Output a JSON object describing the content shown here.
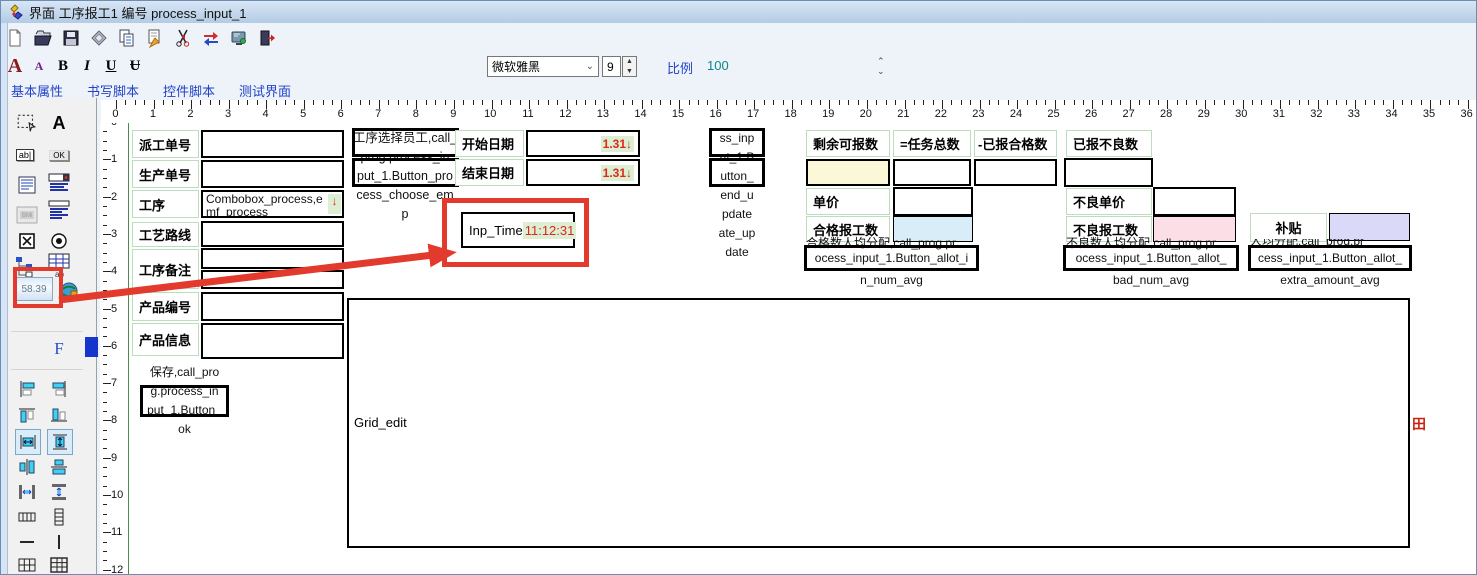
{
  "window": {
    "title": "界面 工序报工1 编号 process_input_1"
  },
  "toolbar": {
    "icons": [
      "new-file",
      "open-folder",
      "save",
      "preview",
      "copy",
      "export",
      "cut",
      "swap-arrows",
      "display",
      "exit"
    ]
  },
  "format": {
    "font_large": "A",
    "font_small": "A",
    "bold": "B",
    "italic": "I",
    "underline": "U",
    "strike": "Ʉ",
    "font_name": "微软雅黑",
    "font_size": "9",
    "scale_label": "比例",
    "scale_value": "100"
  },
  "tabs": {
    "basic": "基本属性",
    "write_script": "书写脚本",
    "control_script": "控件脚本",
    "test_ui": "测试界面"
  },
  "rulers": {
    "h_numbers": [
      0,
      1,
      2,
      3,
      4,
      5,
      6,
      7,
      8,
      9,
      10,
      11,
      12,
      13,
      14,
      15,
      16,
      17,
      18,
      19,
      20,
      21,
      22,
      23,
      24,
      25,
      26,
      27,
      28,
      29,
      30,
      31,
      32,
      33,
      34,
      35,
      36
    ],
    "v_numbers": [
      0,
      1,
      2,
      3,
      4,
      5,
      6,
      7,
      8,
      9,
      10,
      11,
      12
    ]
  },
  "toolbox": {
    "ab": "ab|",
    "ok": "OK",
    "grid_ab": "ab",
    "num_value": "58.39",
    "f": "F"
  },
  "form": {
    "rows": [
      {
        "label": "派工单号"
      },
      {
        "label": "生产单号"
      },
      {
        "label": "工序"
      },
      {
        "label": "工艺路线"
      },
      {
        "label": "工序备注"
      },
      {
        "label": "产品编号"
      },
      {
        "label": "产品信息"
      }
    ],
    "combobox_line1": "Combobox_process,e",
    "combobox_line2": "mf_process",
    "combobox_arrow": "↓"
  },
  "save_button": {
    "l1": "保存,call_pro",
    "l2": "g.process_in",
    "l3": "put_1.Button_",
    "l4": "ok"
  },
  "choose_emp": {
    "l1": "工序选择员工,call_",
    "l2": "prog.process_in",
    "l3": "put_1.Button_pro",
    "l4": "cess_choose_em",
    "l5": "p"
  },
  "dates": {
    "start_label": "开始日期",
    "end_label": "结束日期",
    "start_value": "1.31↓",
    "end_value": "1.31↓"
  },
  "inp_time": {
    "label": "Inp_Time",
    "value": "11:12:31"
  },
  "end_update": {
    "l1": "ss_inp",
    "l2": "ut_1.B",
    "l3": "utton_",
    "l4": "end_u",
    "l5": "pdate",
    "l6": "ate_up",
    "l7": "date"
  },
  "qualified": {
    "h1": "剩余可报数",
    "h2": "=任务总数",
    "h3": "-已报合格数",
    "price_label": "单价",
    "count_label": "合格报工数",
    "note": "合格数人均分配,call_prog.pr",
    "btn": "ocess_input_1.Button_allot_i",
    "name": "n_num_avg"
  },
  "bad": {
    "h1": "已报不良数",
    "price_label": "不良单价",
    "count_label": "不良报工数",
    "note": "不良数人均分配,call_prog.pr",
    "btn": "ocess_input_1.Button_allot_",
    "name": "bad_num_avg"
  },
  "extra": {
    "label": "补贴",
    "note": "人均分配,call_prog.pr",
    "btn": "cess_input_1.Button_allot_",
    "name": "extra_amount_avg"
  },
  "grid": {
    "label": "Grid_edit",
    "corner": "田"
  },
  "colors": {
    "annotation_red": "#e23a2c",
    "value_red": "#e0251a",
    "value_bg": "#dcefd2",
    "label_border": "#bedcbe",
    "cream": "#fbf8da",
    "light_blue": "#d9edf8",
    "pink": "#fcdfe6",
    "lavender": "#dadaf8"
  }
}
